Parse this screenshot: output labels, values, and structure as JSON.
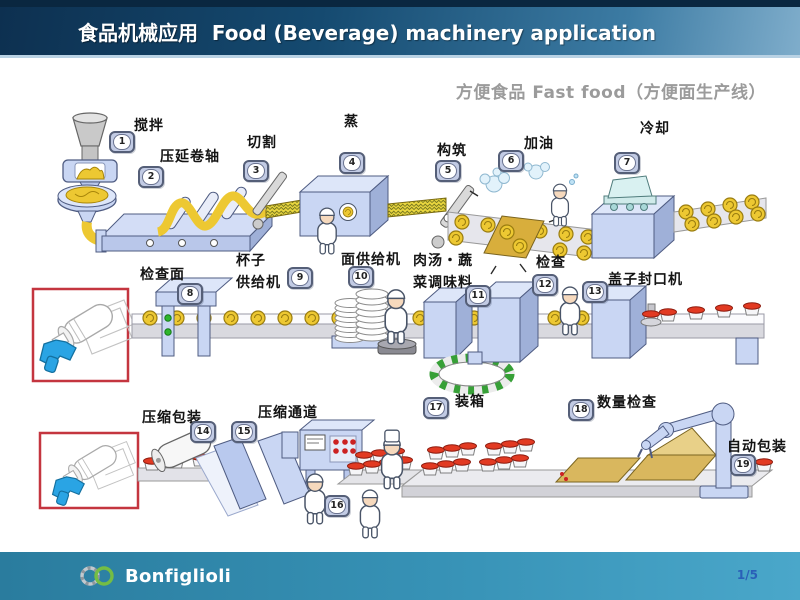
{
  "header": {
    "title": "食品机械应用  Food (Beverage) machinery application"
  },
  "subtitle": "方便食品 Fast food（方便面生产线）",
  "steps": [
    {
      "num": "1",
      "label": "搅拌"
    },
    {
      "num": "2",
      "label": "压延卷轴"
    },
    {
      "num": "3",
      "label": "切割"
    },
    {
      "num": "4",
      "label": "蒸"
    },
    {
      "num": "5",
      "label": "构筑"
    },
    {
      "num": "6",
      "label": "加油"
    },
    {
      "num": "7",
      "label": "冷却"
    },
    {
      "num": "8",
      "label": "检查面"
    },
    {
      "num": "9",
      "label": "杯子\n供给机"
    },
    {
      "num": "10",
      "label": "面供给机"
    },
    {
      "num": "11",
      "label": "肉汤・蔬\n菜调味料"
    },
    {
      "num": "12",
      "label": "检查"
    },
    {
      "num": "13",
      "label": "盖子封口机"
    },
    {
      "num": "14",
      "label": "压缩包装"
    },
    {
      "num": "15",
      "label": "压缩通道"
    },
    {
      "num": "16",
      "label": ""
    },
    {
      "num": "17",
      "label": "装箱"
    },
    {
      "num": "18",
      "label": "数量检查"
    },
    {
      "num": "19",
      "label": "自动包装"
    }
  ],
  "footer": {
    "brand": "Bonfiglioli",
    "page": "1/5"
  },
  "colors": {
    "header_left": "#0d3050",
    "header_right": "#7fadcb",
    "footer_left": "#2a7c9e",
    "footer_right": "#4aa7ca",
    "callout_red": "#c4353f",
    "machine_blue": "#c9d6f3",
    "noodle_yellow": "#edc832",
    "carton_gold": "#d9b75e",
    "lid_red": "#e23a22",
    "badge_fill": "#c2cbe4",
    "page_number_blue": "#2a5fb8",
    "logo_green": "#74bd44"
  }
}
